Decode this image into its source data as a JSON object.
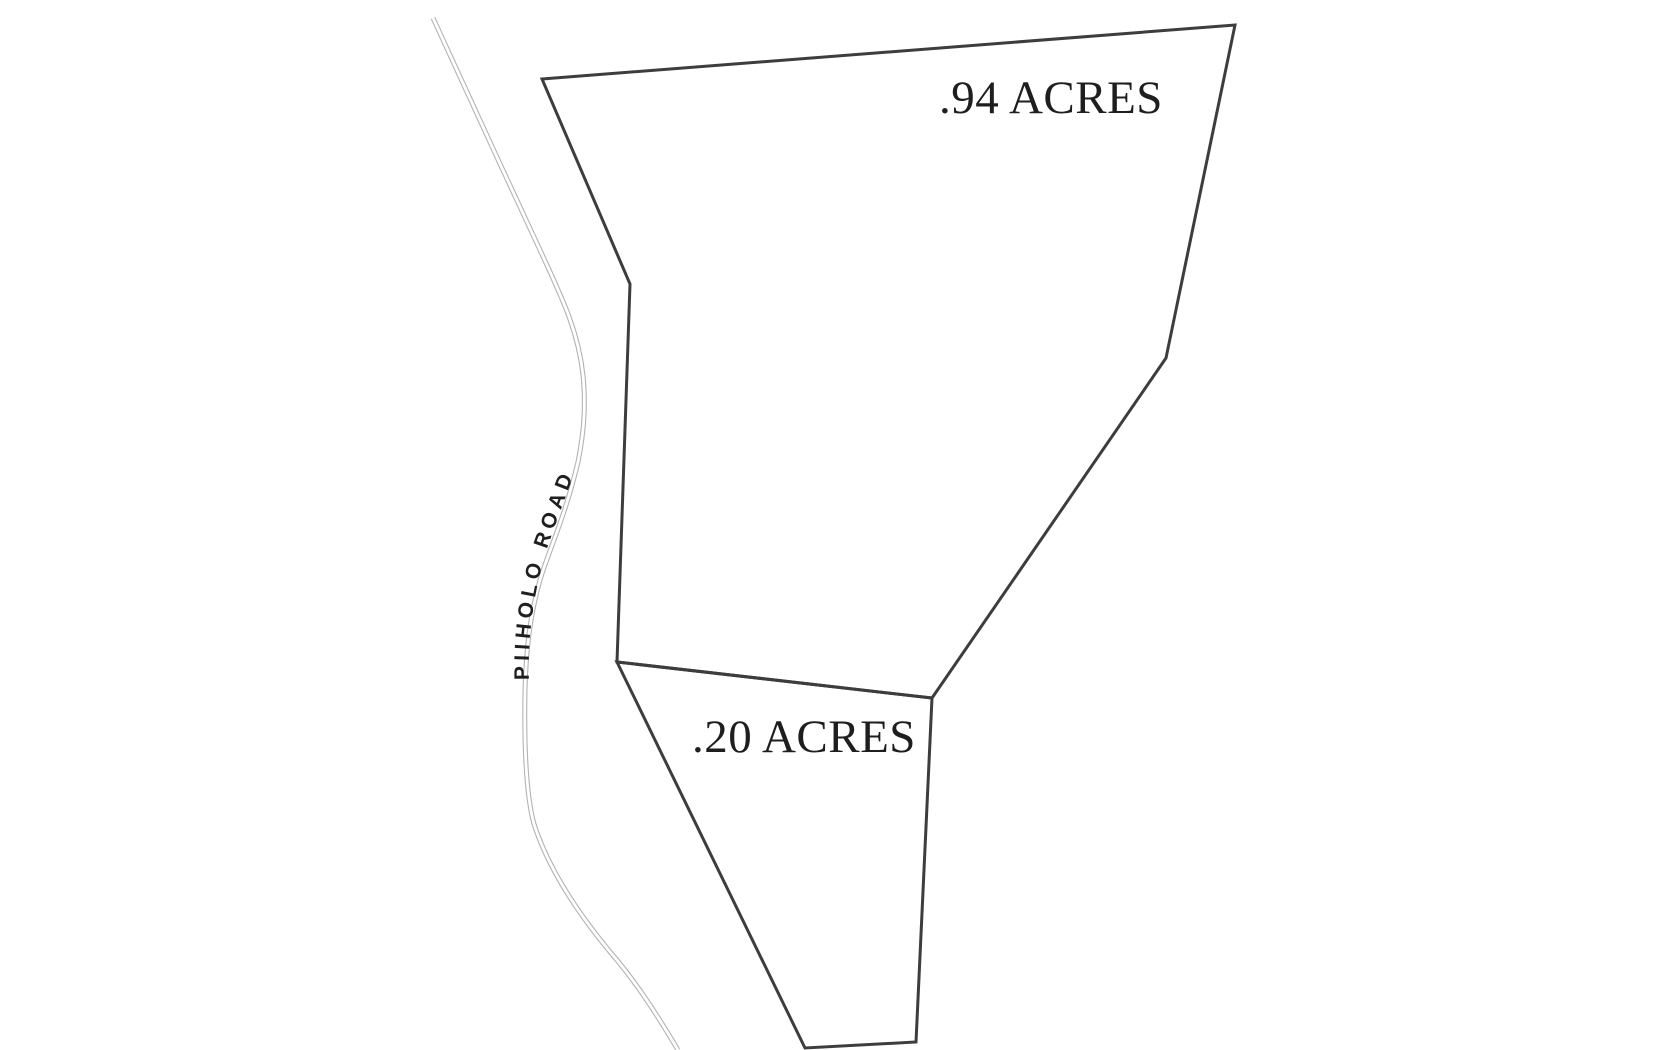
{
  "map": {
    "kind": "parcel-plat-map",
    "road": {
      "name": "PIIHOLO ROAD",
      "centerline_path": "M 433 18 C 465 88 505 175 540 250 C 562 298 578 330 583 375 C 586 405 584 432 578 462 C 565 517 549 550 540 580 C 530 615 526 650 525 690 C 524 745 526 795 534 824 C 548 868 577 912 611 953 C 637 983 659 1018 678 1050",
      "label_path": "M 529 680 C 527 630 537 575 551 537 C 566 495 577 465 594 428"
    },
    "parcels": [
      {
        "id": "parcel-94",
        "label": ".94 ACRES",
        "acres": 0.94,
        "outline_points": "542,79 1235,25 1166,358 932,698 617,662 630,284"
      },
      {
        "id": "parcel-20",
        "label": ".20 ACRES",
        "acres": 0.2,
        "outline_points": "617,662 932,698 916,1042 805,1048"
      }
    ],
    "colors": {
      "background": "#ffffff",
      "parcel_outline": "#3d3d3d",
      "road_line": "#b3b3b3",
      "label_text": "#1e1e1e"
    }
  }
}
